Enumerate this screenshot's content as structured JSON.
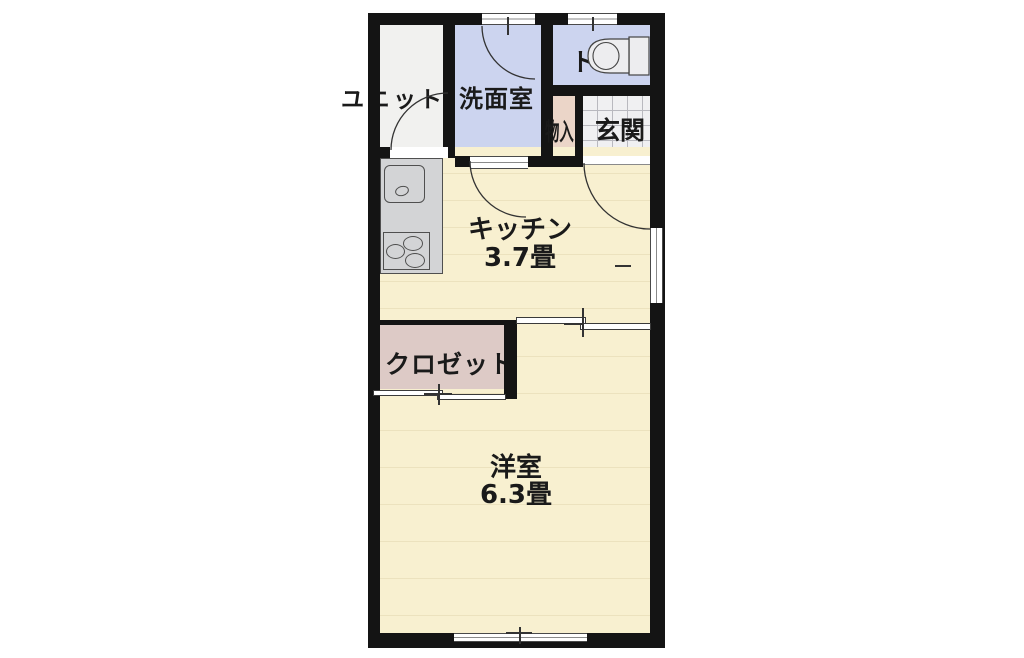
{
  "rooms": {
    "unit_bath": {
      "label": "ユニット"
    },
    "washroom": {
      "label": "洗面室"
    },
    "toilet": {
      "label": "トイレ"
    },
    "storage": {
      "label": "物入"
    },
    "entrance": {
      "label": "玄関"
    },
    "kitchen": {
      "label": "キッチン",
      "size": "3.7畳"
    },
    "closet": {
      "label": "クロゼット"
    },
    "western_room": {
      "label": "洋室",
      "size": "6.3畳"
    }
  },
  "colors": {
    "wall": "#141414",
    "water_area": "#ccd4ef",
    "unit_bath_floor": "#f1f1ef",
    "flooring": "#f8f0d0",
    "flooring_stripe": "#ece2be",
    "storage": "#ebd5c8",
    "closet": "#ddcac6",
    "entrance_tile": "#f0f0f2",
    "counter": "#d3d4d6"
  }
}
